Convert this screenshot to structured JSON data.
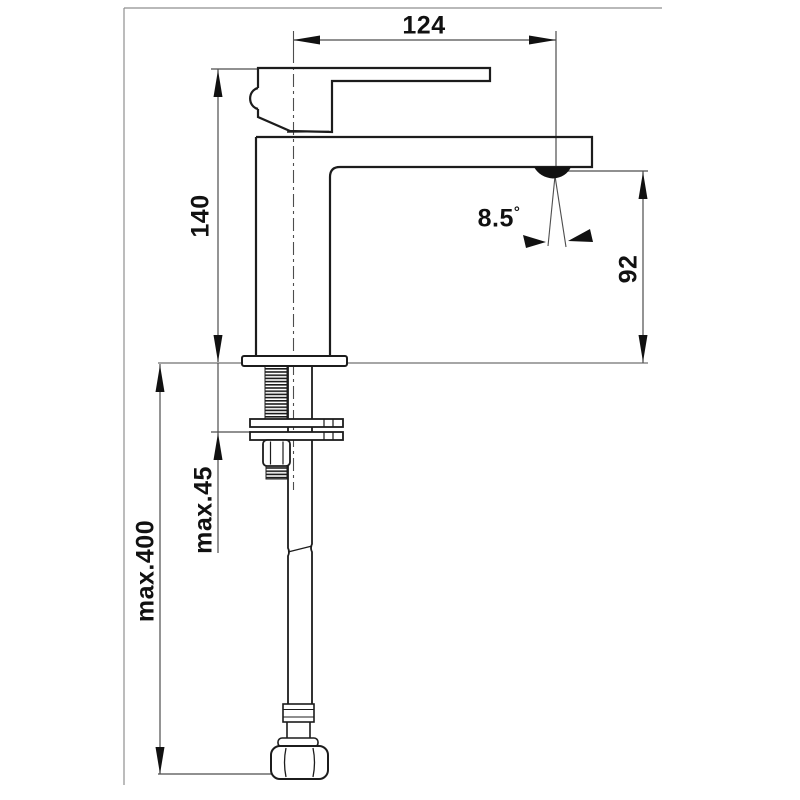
{
  "drawing": {
    "type": "technical-dimension-drawing",
    "dimensions": {
      "spout_reach": "124",
      "body_height": "140",
      "outlet_height": "92",
      "stream_angle": "8.5",
      "degree_symbol": "°",
      "max_deck_thickness": "max.45",
      "max_hose_length": "max.400"
    },
    "colors": {
      "outline": "#1c1c1c",
      "dimension_line": "#4d4d4d",
      "frame": "#8f8f8f",
      "text": "#111111",
      "background": "#ffffff"
    }
  }
}
